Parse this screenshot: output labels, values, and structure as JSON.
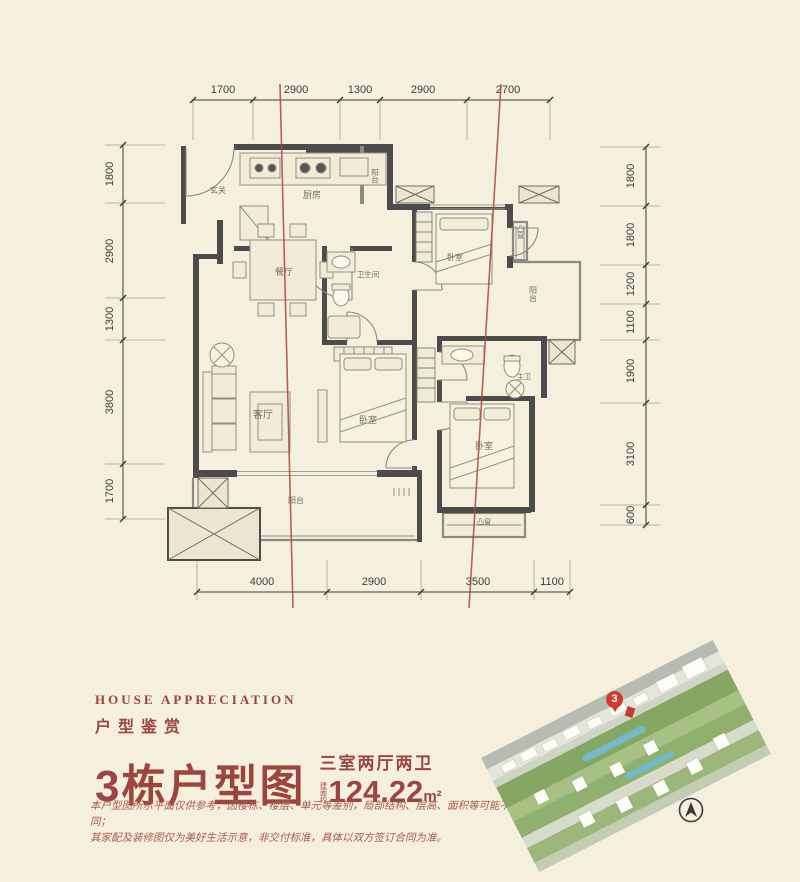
{
  "plan": {
    "dims": {
      "top": [
        "1700",
        "2900",
        "1300",
        "2900",
        "2700"
      ],
      "bottom": [
        "4000",
        "2900",
        "3500",
        "1100"
      ],
      "left": [
        "1800",
        "2900",
        "1300",
        "3800",
        "1700"
      ],
      "right": [
        "1800",
        "1800",
        "1200",
        "1100",
        "1900",
        "3100",
        "600"
      ]
    },
    "rooms": {
      "entry": "玄关",
      "kitchen": "厨房",
      "kitchen_balcony": "阳台",
      "dining": "餐厅",
      "bath": "卫生间",
      "bedroom2": "卧室",
      "bay_right": "凸窗",
      "balcony_right": "阳台",
      "living": "客厅",
      "bedroom3": "卧室",
      "master_bath": "主卫",
      "master": "卧室",
      "balcony_bottom": "阳台",
      "bay_bottom": "凸窗"
    },
    "colors": {
      "wall": "#4c4c4c",
      "axis_red": "#b5443c"
    }
  },
  "info": {
    "eyebrow_en": "HOUSE APPRECIATION",
    "eyebrow_cn": "户型鉴赏",
    "title": "3栋户型图",
    "spec": "三室两厅两卫",
    "area_prefix": "建面约",
    "area_value": "124.22",
    "area_unit": "m²",
    "disclaimer_line1": "本户型图所示平面仅供参考，因楼栋、楼层、单元等差别，局部结构、层高、面积等可能不同；",
    "disclaimer_line2": "其家配及装修图仅为美好生活示意，非交付标准，具体以双方签订合同为准。",
    "accent": "#9c453e"
  },
  "siteplan": {
    "pin_label": "3"
  }
}
